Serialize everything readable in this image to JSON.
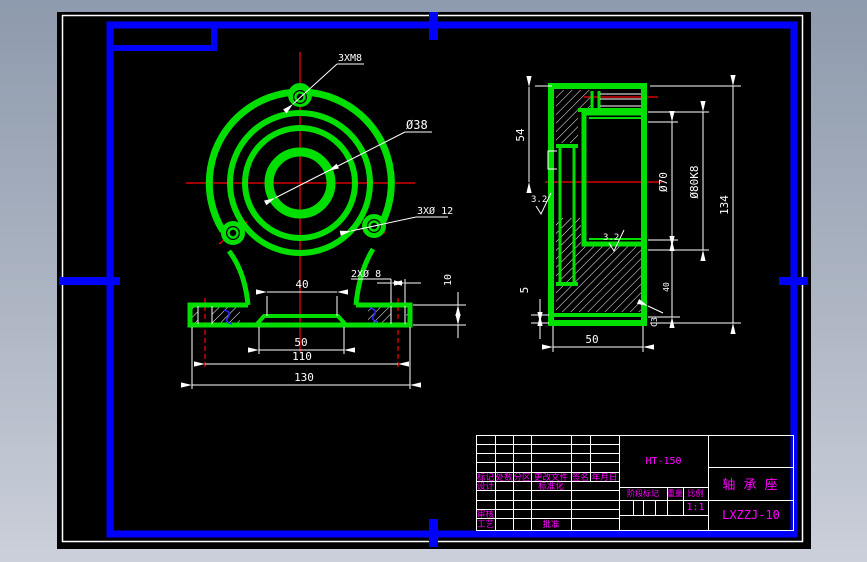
{
  "window": {
    "description": "CAD drawing viewer showing a bearing seat engineering drawing on black model space with blue GB drawing frame"
  },
  "colors": {
    "geometry_green": "#00df00",
    "frame_blue": "#0000ff",
    "dimension_white": "#ffffff",
    "centerline_red": "#ff0000",
    "titleblock_magenta": "#ff00ff",
    "canvas_black": "#000000"
  },
  "front_view": {
    "thread_note": "3XM8",
    "bore_dia": "Ø38",
    "hole_note": "3XØ 12",
    "base_hole_note": "2XØ 8",
    "w40": "40",
    "w50": "50",
    "w110": "110",
    "w130": "130",
    "h10": "10"
  },
  "side_view": {
    "h54": "54",
    "h5": "5",
    "w50": "50",
    "d70": "Ø70",
    "d80": "Ø80K8",
    "h134": "134",
    "h40": "40",
    "rough1": "3.2",
    "rough2": "3.2",
    "chamfer": "C3"
  },
  "title_block": {
    "material": "HT-150",
    "part_name": "轴 承 座",
    "drawing_no": "LXZZJ-10",
    "scale_value": "1:1",
    "labels": {
      "mark": "标记",
      "qty": "处数",
      "zone": "分区",
      "doc": "更改文件",
      "sign": "签名",
      "date": "年月日",
      "design": "设计",
      "standard": "标准化",
      "stage": "阶段标记",
      "weight": "重量",
      "scale": "比例",
      "audit": "审核",
      "process": "工艺",
      "approve": "批准"
    }
  }
}
